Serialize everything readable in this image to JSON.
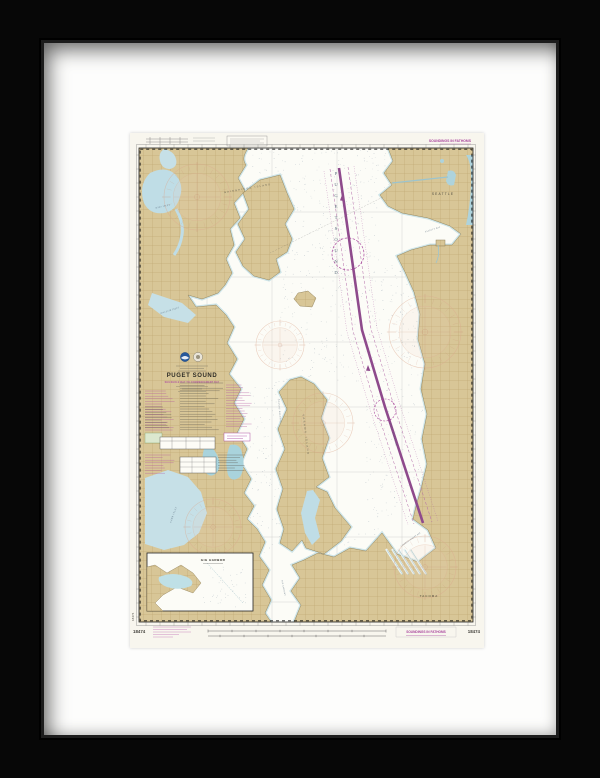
{
  "chart": {
    "top_note": "SOUNDINGS IN FATHOMS",
    "number": "18474",
    "title_block": {
      "title": "PUGET SOUND",
      "subtitle": "SHILSHOLE BAY TO COMMENCEMENT BAY"
    },
    "bottom": {
      "soundings_note": "SOUNDINGS IN FATHOMS"
    },
    "inset": {
      "title": "GIG HARBOR"
    }
  },
  "map": {
    "labels": [
      {
        "text": "PUGET SOUND",
        "x": 206,
        "y": 42,
        "rot": 0,
        "fs": 4.6,
        "color": "#4a5d70",
        "ls": 0,
        "italic": false,
        "vertical": true,
        "step": 11
      },
      {
        "text": "SEATTLE",
        "x": 313,
        "y": 62,
        "rot": 0,
        "fs": 3.2,
        "color": "#3a382f",
        "ls": 1.2,
        "italic": false,
        "vertical": false
      },
      {
        "text": "TACOMA",
        "x": 299,
        "y": 464,
        "rot": 0,
        "fs": 3.0,
        "color": "#3a382f",
        "ls": 1.0,
        "italic": false,
        "vertical": false
      },
      {
        "text": "BAINBRIDGE ISLAND",
        "x": 118,
        "y": 56,
        "rot": -10,
        "fs": 2.4,
        "color": "#57544a",
        "ls": 1.4,
        "italic": false,
        "vertical": false
      },
      {
        "text": "VASHON ISLAND",
        "x": 175,
        "y": 302,
        "rot": 83,
        "fs": 2.6,
        "color": "#57544a",
        "ls": 1.6,
        "italic": false,
        "vertical": false
      },
      {
        "text": "COLVOS PASSAGE",
        "x": 149,
        "y": 278,
        "rot": 85,
        "fs": 2.0,
        "color": "#4a5d70",
        "ls": 0.6,
        "italic": true,
        "vertical": false
      },
      {
        "text": "EAST PASSAGE",
        "x": 263,
        "y": 302,
        "rot": 75,
        "fs": 2.2,
        "color": "#4a5d70",
        "ls": 0.8,
        "italic": true,
        "vertical": false
      },
      {
        "text": "ELLIOTT BAY",
        "x": 303,
        "y": 97,
        "rot": -18,
        "fs": 2.0,
        "color": "#4a5d70",
        "ls": 0.4,
        "italic": true,
        "vertical": false
      },
      {
        "text": "DYES INLET",
        "x": 33,
        "y": 74,
        "rot": -12,
        "fs": 2.0,
        "color": "#4a5d70",
        "ls": 0.4,
        "italic": true,
        "vertical": false
      },
      {
        "text": "SINCLAIR INLET",
        "x": 40,
        "y": 178,
        "rot": -18,
        "fs": 2.0,
        "color": "#4a5d70",
        "ls": 0.4,
        "italic": true,
        "vertical": false
      },
      {
        "text": "CARR INLET",
        "x": 44,
        "y": 382,
        "rot": -70,
        "fs": 2.2,
        "color": "#4a5d70",
        "ls": 0.5,
        "italic": true,
        "vertical": false
      },
      {
        "text": "COMMENCEMENT BAY",
        "x": 281,
        "y": 407,
        "rot": -35,
        "fs": 1.9,
        "color": "#4a5d70",
        "ls": 0.3,
        "italic": true,
        "vertical": false
      },
      {
        "text": "THE NARROWS",
        "x": 153,
        "y": 455,
        "rot": 78,
        "fs": 1.9,
        "color": "#4a5d70",
        "ls": 0.3,
        "italic": true,
        "vertical": false
      }
    ]
  },
  "colors": {
    "frame": "#0a0a0a",
    "mat": "#fdfdfc",
    "paper": "#f8f6ee",
    "land": "#d8c697",
    "shallow": "#bfdde4",
    "lake": "#a9d3dc",
    "water": "#fcfcf7",
    "magenta": "#a8449c",
    "lane": "#8e4a8c",
    "rose": "#dca88e"
  }
}
